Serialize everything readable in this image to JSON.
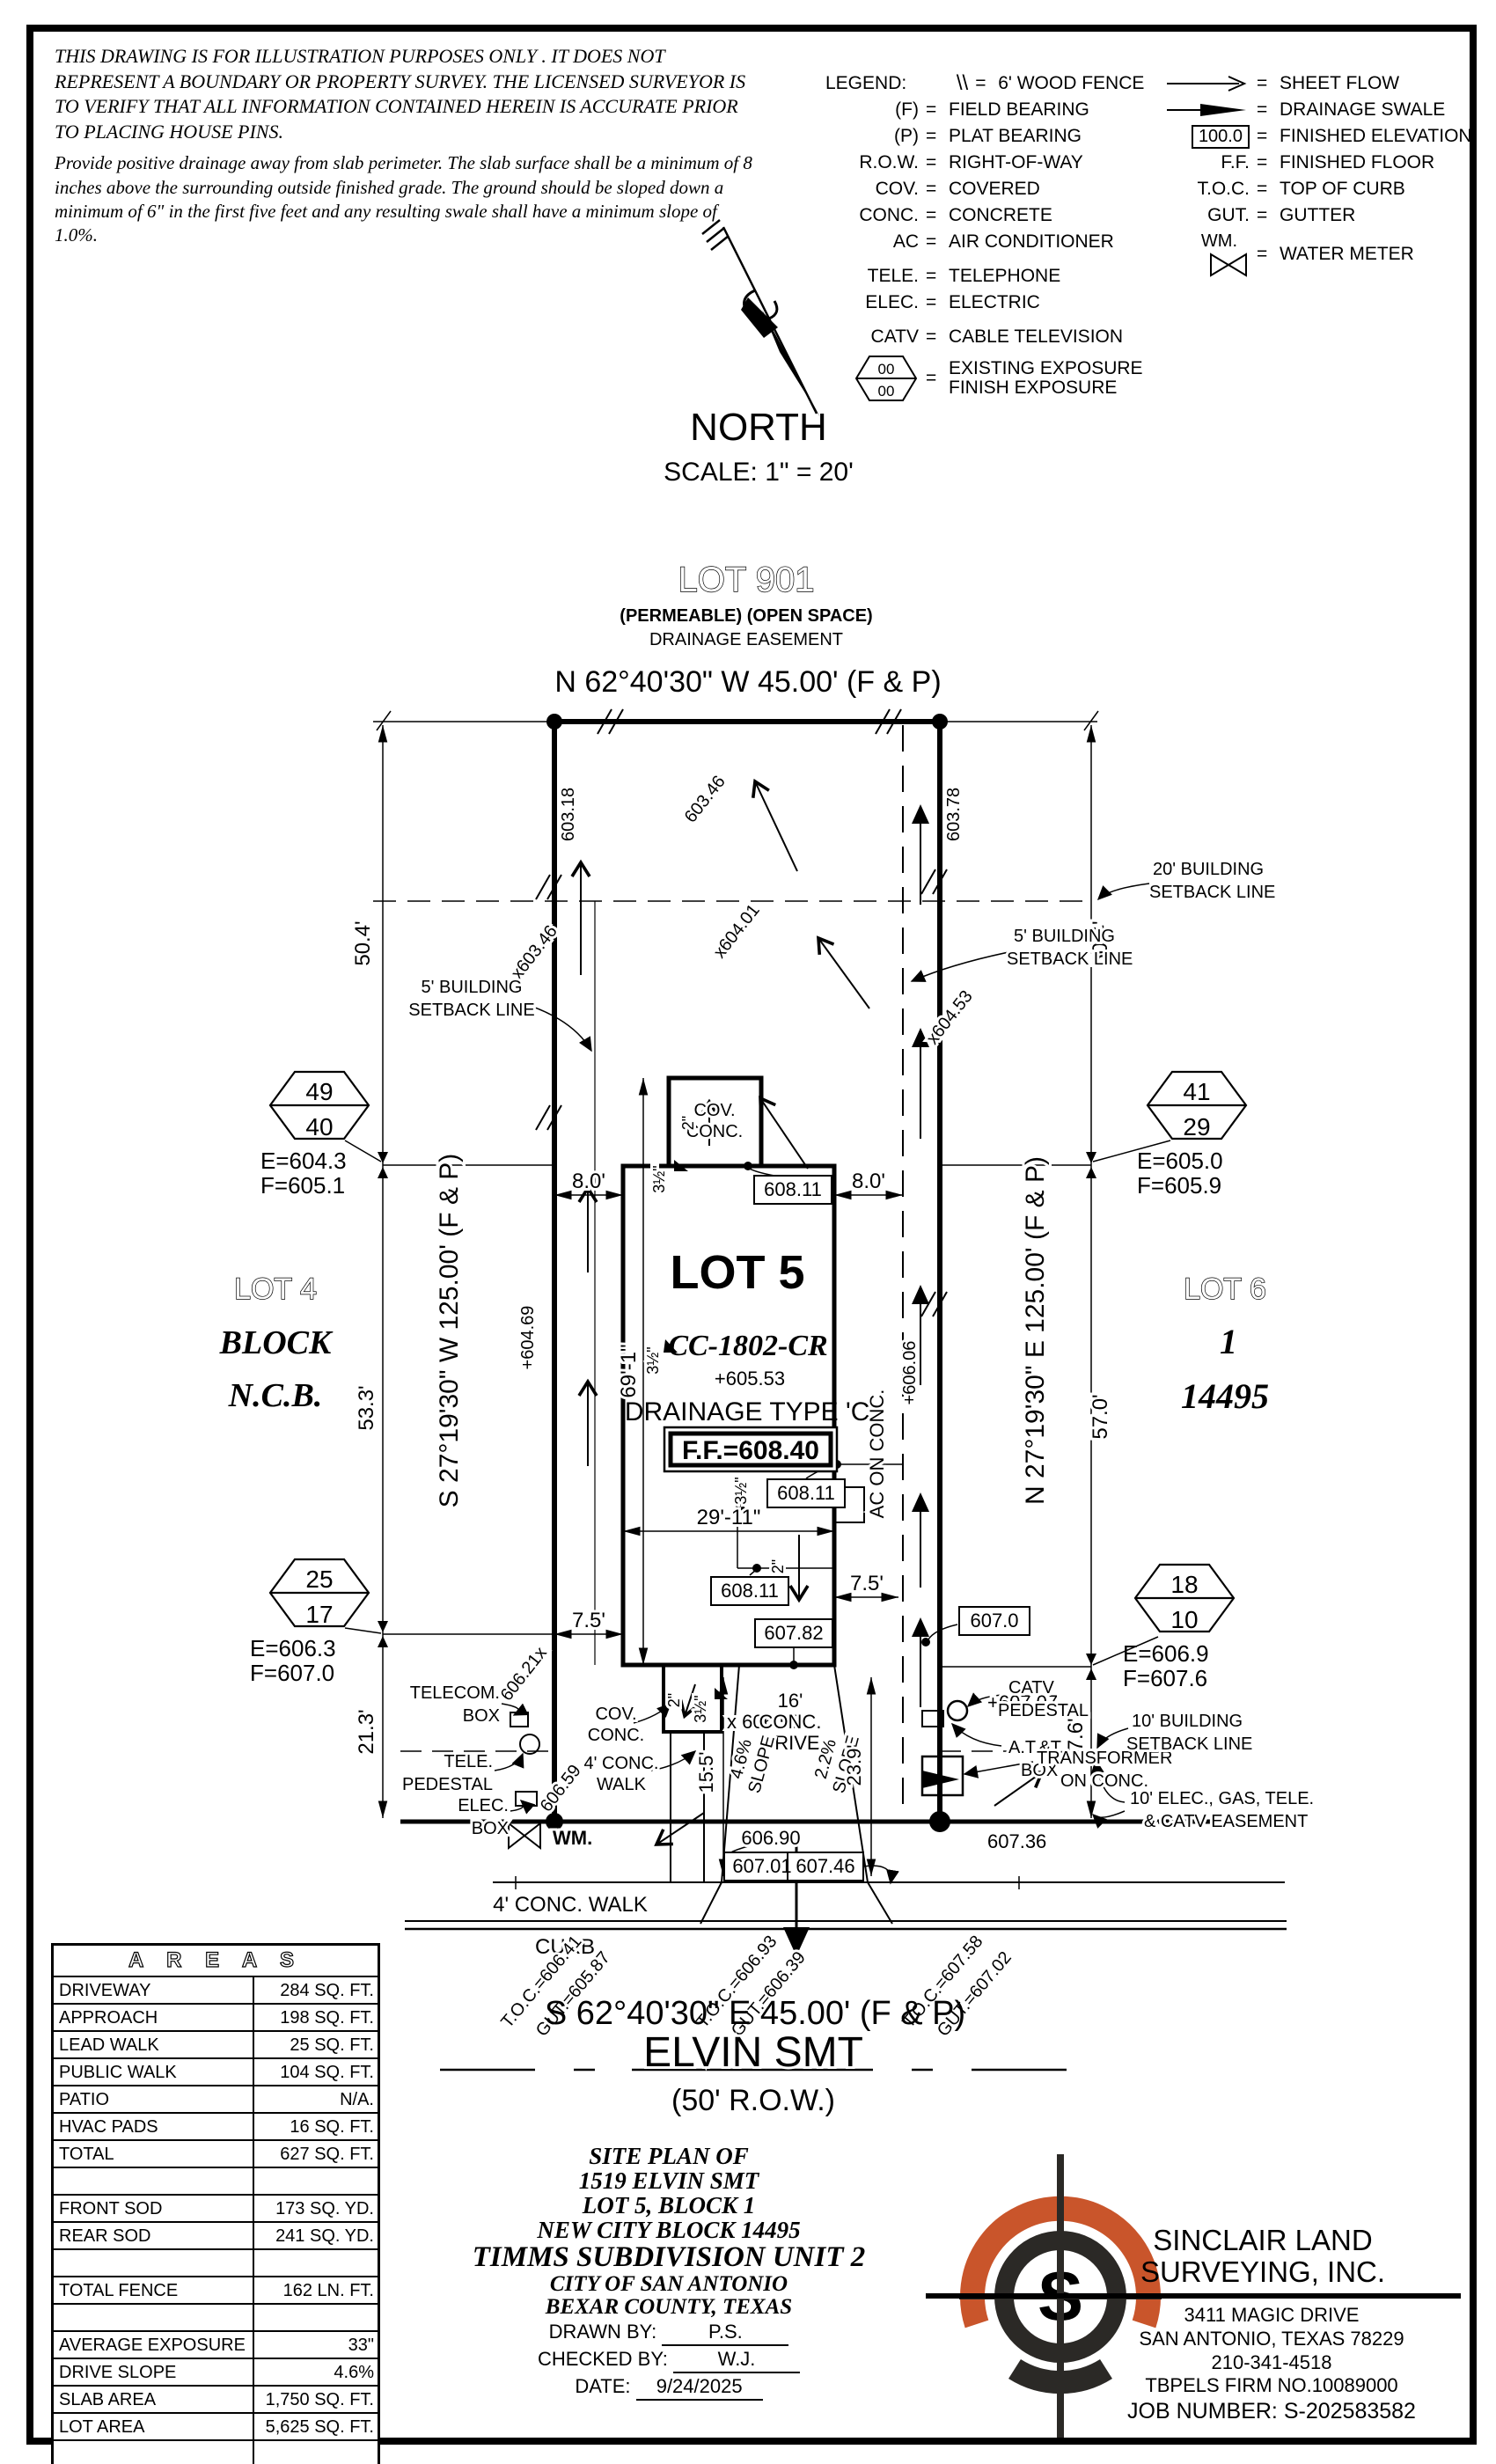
{
  "disclaimer": {
    "p1": "THIS DRAWING IS FOR ILLUSTRATION PURPOSES ONLY . IT DOES NOT REPRESENT A BOUNDARY OR PROPERTY SURVEY. THE LICENSED SURVEYOR IS TO VERIFY THAT ALL INFORMATION CONTAINED HEREIN IS ACCURATE PRIOR TO PLACING HOUSE PINS.",
    "p2": "Provide positive drainage away from slab perimeter. The slab surface shall be a minimum of 8 inches above the surrounding outside finished grade. The ground should be sloped down a minimum of 6\" in the first five feet and any resulting swale shall have a minimum slope of 1.0%."
  },
  "legend": {
    "title": "LEGEND:",
    "eq": "=",
    "left": [
      {
        "sym": "\\\\",
        "name": "6' WOOD FENCE"
      },
      {
        "sym": "(F)",
        "name": "FIELD BEARING"
      },
      {
        "sym": "(P)",
        "name": "PLAT BEARING"
      },
      {
        "sym": "R.O.W.",
        "name": "RIGHT-OF-WAY"
      },
      {
        "sym": "COV.",
        "name": "COVERED"
      },
      {
        "sym": "CONC.",
        "name": "CONCRETE"
      },
      {
        "sym": "AC",
        "name": "AIR CONDITIONER"
      },
      {
        "sym": "TELE.",
        "name": "TELEPHONE"
      },
      {
        "sym": "ELEC.",
        "name": "ELECTRIC"
      },
      {
        "sym": "CATV",
        "name": "CABLE TELEVISION"
      }
    ],
    "hex": {
      "top": "00",
      "bottom": "00",
      "line1": "EXISTING EXPOSURE",
      "line2": "FINISH EXPOSURE"
    },
    "right": [
      {
        "sym": "",
        "name": "SHEET FLOW"
      },
      {
        "sym": "",
        "name": "DRAINAGE SWALE"
      },
      {
        "sym": "100.0",
        "name": "FINISHED ELEVATION"
      },
      {
        "sym": "F.F.",
        "name": "FINISHED FLOOR"
      },
      {
        "sym": "T.O.C.",
        "name": "TOP OF CURB"
      },
      {
        "sym": "GUT.",
        "name": "GUTTER"
      },
      {
        "sym": "WM.",
        "name": "WATER METER"
      }
    ]
  },
  "north": {
    "label": "NORTH",
    "scale": "SCALE: 1\" = 20'"
  },
  "plan": {
    "lot901": "LOT 901",
    "lot901_sub": "(PERMEABLE) (OPEN SPACE)",
    "lot901_sub2": "DRAINAGE EASEMENT",
    "bearing_top": "N 62°40'30\" W 45.00' (F & P)",
    "bearing_bottom": "S 62°40'30\" E 45.00' (F & P)",
    "bearing_west": "S 27°19'30\" W 125.00' (F & P)",
    "bearing_east": "N 27°19'30\" E 125.00' (F & P)",
    "street": "ELVIN SMT",
    "row50": "(50' R.O.W.)",
    "lot4": "LOT 4",
    "lot4_block": "BLOCK",
    "lot4_ncb": "N.C.B.",
    "lot6": "LOT 6",
    "lot6_num": "1",
    "lot6_ncb": "14495",
    "lot5": "LOT 5",
    "model": "CC-1802-CR",
    "pad": "+605.53",
    "drainage": "DRAINAGE TYPE 'C'",
    "ff": "F.F.=608.40",
    "sb20a": "20' BUILDING",
    "sb20b": "SETBACK LINE",
    "sb5a": "5' BUILDING",
    "sb5b": "SETBACK LINE",
    "sb10a": "10' BUILDING",
    "sb10b": "SETBACK LINE",
    "ease10a": "10' ELEC., GAS, TELE.",
    "ease10b": "& CATV EASEMENT",
    "cov": "COV.",
    "conc": "CONC.",
    "ac": "AC ON CONC.",
    "drive16a": "16'",
    "drive16b": "CONC.",
    "drive16c": "DRIVE",
    "walk4": "4' CONC. WALK",
    "walk4a": "4' CONC.",
    "walk4b": "WALK",
    "curb": "CURB",
    "wm": "WM.",
    "telecom_a": "TELECOM.",
    "telecom_b": "BOX",
    "telep_a": "TELE.",
    "telep_b": "PEDESTAL",
    "elec_a": "ELEC.",
    "elec_b": "BOX",
    "catv_a": "CATV",
    "catv_b": "PEDESTAL",
    "att_a": "A.T.&T.",
    "att_b": "BOX",
    "xfmr_a": "TRANSFORMER",
    "xfmr_b": "ON CONC.",
    "hex_tl_t": "49",
    "hex_tl_b": "40",
    "hex_tr_t": "41",
    "hex_tr_b": "29",
    "hex_bl_t": "25",
    "hex_bl_b": "17",
    "hex_br_t": "18",
    "hex_br_b": "10",
    "ef_tl_e": "E=604.3",
    "ef_tl_f": "F=605.1",
    "ef_tr_e": "E=605.0",
    "ef_tr_f": "F=605.9",
    "ef_bl_e": "E=606.3",
    "ef_bl_f": "F=607.0",
    "ef_br_e": "E=606.9",
    "ef_br_f": "F=607.6",
    "d50_4": "50.4'",
    "d53_3": "53.3'",
    "d21_3": "21.3'",
    "d57_0": "57.0'",
    "d17_6": "17.6'",
    "d8_0": "8.0'",
    "d7_5": "7.5'",
    "d69_1": "69'-1\"",
    "d29_11": "29'-11\"",
    "d15_5": "15.5'",
    "d23_9": "23.9'",
    "d2": "2\"",
    "d35": "3½\"",
    "s46": "4.6%",
    "s22": "2.2%",
    "slope": "SLOPE",
    "sp603_18": "603.18",
    "sp603_46": "603.46",
    "sp603_78": "603.78",
    "spx603_46": "x603.46",
    "spx604_01": "x604.01",
    "spx604_53": "x604.53",
    "sp604_69": "+604.69",
    "sp606_06": "+606.06",
    "sp606_21": "606.21x",
    "sp606_59": "606.59",
    "sp606_56": "x 606.56",
    "sp607_07": "+607.07",
    "sp606_90": "606.90",
    "sp607_36": "607.36",
    "b608_11": "608.11",
    "b607_82": "607.82",
    "b607_0": "607.0",
    "b607_01": "607.01",
    "b607_46": "607.46",
    "toc1a": "T.O.C.=606.41",
    "toc1b": "GUT.=605.87",
    "toc2a": "T.O.C.=606.93",
    "toc2b": "GUT.=606.39",
    "toc3a": "T.O.C.=607.58",
    "toc3b": "GUT.=607.02"
  },
  "areas": {
    "title": "A R E A S",
    "rows": [
      {
        "label": "DRIVEWAY",
        "value": "284 SQ. FT."
      },
      {
        "label": "APPROACH",
        "value": "198 SQ. FT."
      },
      {
        "label": "LEAD WALK",
        "value": "25 SQ. FT."
      },
      {
        "label": "PUBLIC WALK",
        "value": "104 SQ. FT."
      },
      {
        "label": "PATIO",
        "value": "N/A."
      },
      {
        "label": "HVAC PADS",
        "value": "16 SQ. FT."
      },
      {
        "label": "TOTAL",
        "value": "627 SQ. FT."
      },
      {
        "label": "",
        "value": ""
      },
      {
        "label": "FRONT SOD",
        "value": "173 SQ. YD."
      },
      {
        "label": "REAR SOD",
        "value": "241 SQ. YD."
      },
      {
        "label": "",
        "value": ""
      },
      {
        "label": "TOTAL FENCE",
        "value": "162 LN. FT."
      },
      {
        "label": "",
        "value": ""
      },
      {
        "label": "AVERAGE EXPOSURE",
        "value": "33\""
      },
      {
        "label": "DRIVE SLOPE",
        "value": "4.6%"
      },
      {
        "label": "SLAB AREA",
        "value": "1,750 SQ. FT."
      },
      {
        "label": "LOT AREA",
        "value": "5,625 SQ. FT."
      },
      {
        "label": "",
        "value": ""
      }
    ]
  },
  "title_block": {
    "l1": "SITE PLAN OF",
    "l2": "1519 ELVIN SMT",
    "l3": "LOT 5, BLOCK 1",
    "l4": "NEW CITY BLOCK 14495",
    "l5": "TIMMS SUBDIVISION UNIT 2",
    "l6": "CITY OF SAN ANTONIO",
    "l7": "BEXAR COUNTY, TEXAS",
    "drawn_label": "DRAWN BY:",
    "drawn_value": "P.S.",
    "checked_label": "CHECKED BY:",
    "checked_value": "W.J.",
    "date_label": "DATE:",
    "date_value": "9/24/2025"
  },
  "firm": {
    "name1": "SINCLAIR LAND",
    "name2": "SURVEYING, INC.",
    "addr1": "3411 MAGIC DRIVE",
    "addr2": "SAN ANTONIO, TEXAS 78229",
    "phone": "210-341-4518",
    "firm_no": "TBPELS FIRM NO.10089000",
    "job": "JOB NUMBER:  S-202583582",
    "logo_letter": "S",
    "accent_color": "#c9552b"
  }
}
